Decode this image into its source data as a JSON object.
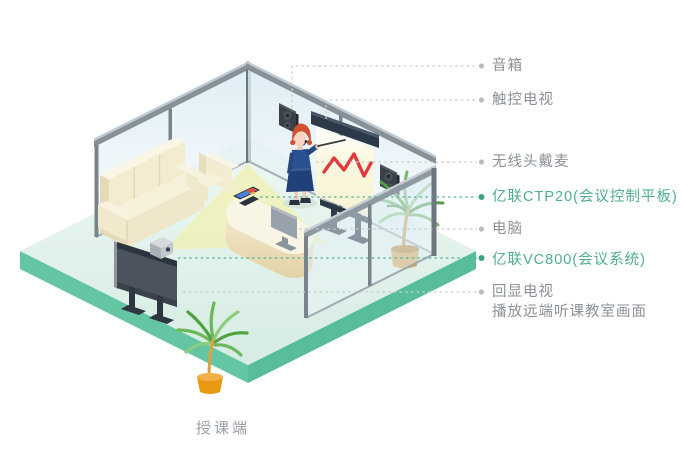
{
  "colors": {
    "accent_green": "#4fae8e",
    "label_gray": "#8b9197",
    "caption_gray": "#999fa4",
    "leader_line_gray": "#c9cbcd",
    "platform_teal": "#5fc2a0",
    "floor_mint": "#ddefe9",
    "chart_line_red": "#e0393e"
  },
  "diagram": {
    "caption": "授课端",
    "callouts": [
      {
        "label": "音箱",
        "accent": false
      },
      {
        "label": "触控电视",
        "accent": false
      },
      {
        "label": "无线头戴麦",
        "accent": false
      },
      {
        "label": "亿联CTP20(会议控制平板)",
        "accent": true
      },
      {
        "label": "电脑",
        "accent": false
      },
      {
        "label": "亿联VC800(会议系统)",
        "accent": true
      },
      {
        "label": "回显电视",
        "sublabel": "播放远端听课教室画面",
        "accent": false
      }
    ]
  }
}
